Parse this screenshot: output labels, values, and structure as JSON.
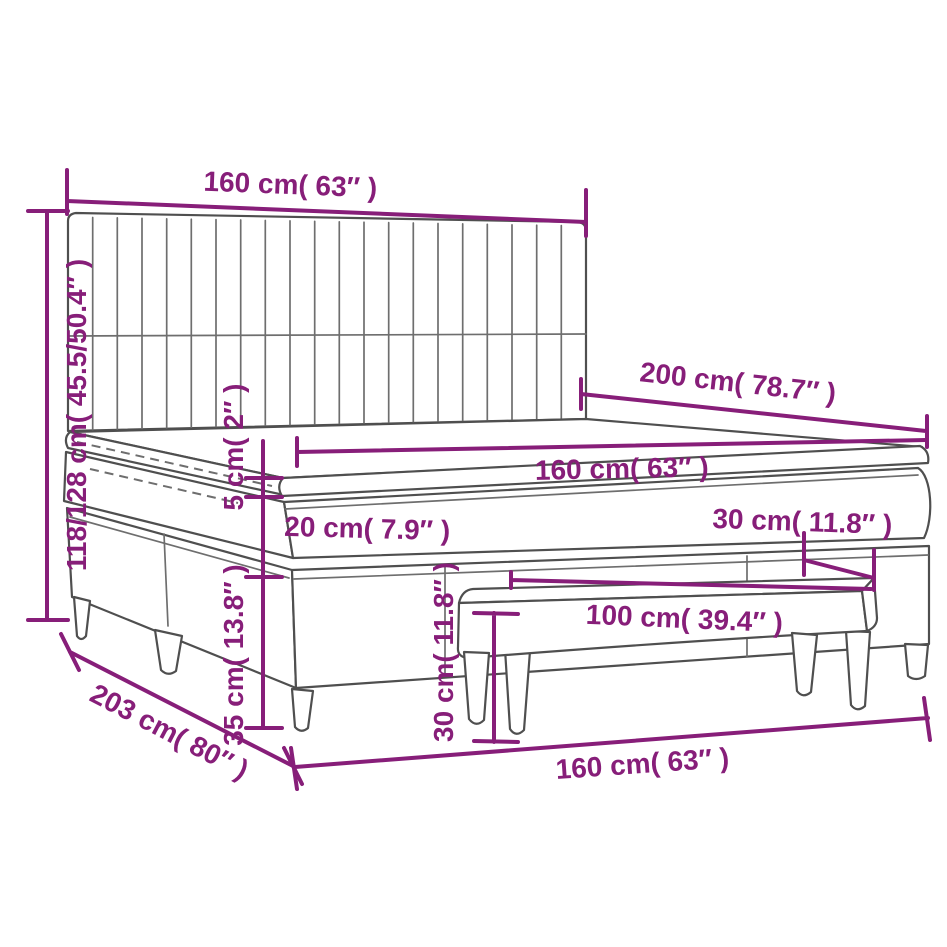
{
  "colors": {
    "dimension": "#871e79",
    "outline": "#4f4f4f",
    "outline_light": "#6e6e6e",
    "background": "#ffffff"
  },
  "diagram": {
    "labels": {
      "headboard_width": "160 cm( 63″ )",
      "bed_height": "118/128 cm( 45.5/50.4″ )",
      "bed_length": "200 cm( 78.7″ )",
      "mattress_width": "160 cm( 63″ )",
      "topper_height": "5 cm( 2″ )",
      "mattress_height": "20 cm( 7.9″ )",
      "bench_depth": "30 cm( 11.8″ )",
      "bench_width": "100 cm( 39.4″ )",
      "bench_height": "30 cm( 11.8″ )",
      "base_height": "35 cm( 13.8″ )",
      "total_length": "203 cm( 80″ )",
      "base_width": "160 cm( 63″ )"
    }
  }
}
